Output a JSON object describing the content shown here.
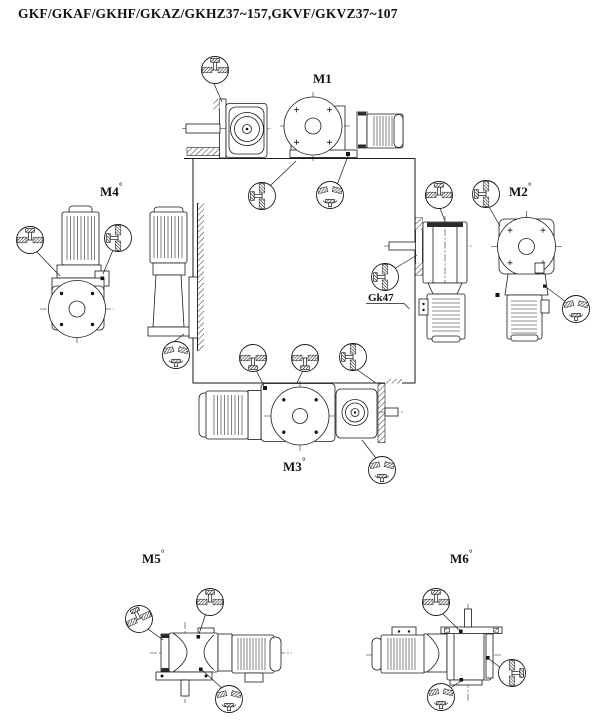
{
  "page": {
    "title": "GKF/GKAF/GKHF/GKAZ/GKHZ37~157,GKVF/GKVZ37~107",
    "background_color": "#ffffff",
    "line_color": "#1a1a1a"
  },
  "mounting_positions": [
    {
      "id": "m1",
      "label": "M1",
      "mark": ""
    },
    {
      "id": "m2",
      "label": "M2",
      "mark": "°"
    },
    {
      "id": "m3",
      "label": "M3",
      "mark": "°"
    },
    {
      "id": "m4",
      "label": "M4",
      "mark": "°"
    },
    {
      "id": "m5",
      "label": "M5",
      "mark": "°"
    },
    {
      "id": "m6",
      "label": "M6",
      "mark": "°"
    }
  ],
  "callout": {
    "label": "Gk47"
  },
  "plug_icons": {
    "breather": "breather-plug-icon",
    "oil_level": "oil-level-plug-icon",
    "oil_fill": "oil-fill-plug-icon",
    "oil_drain": "oil-drain-plug-icon"
  }
}
